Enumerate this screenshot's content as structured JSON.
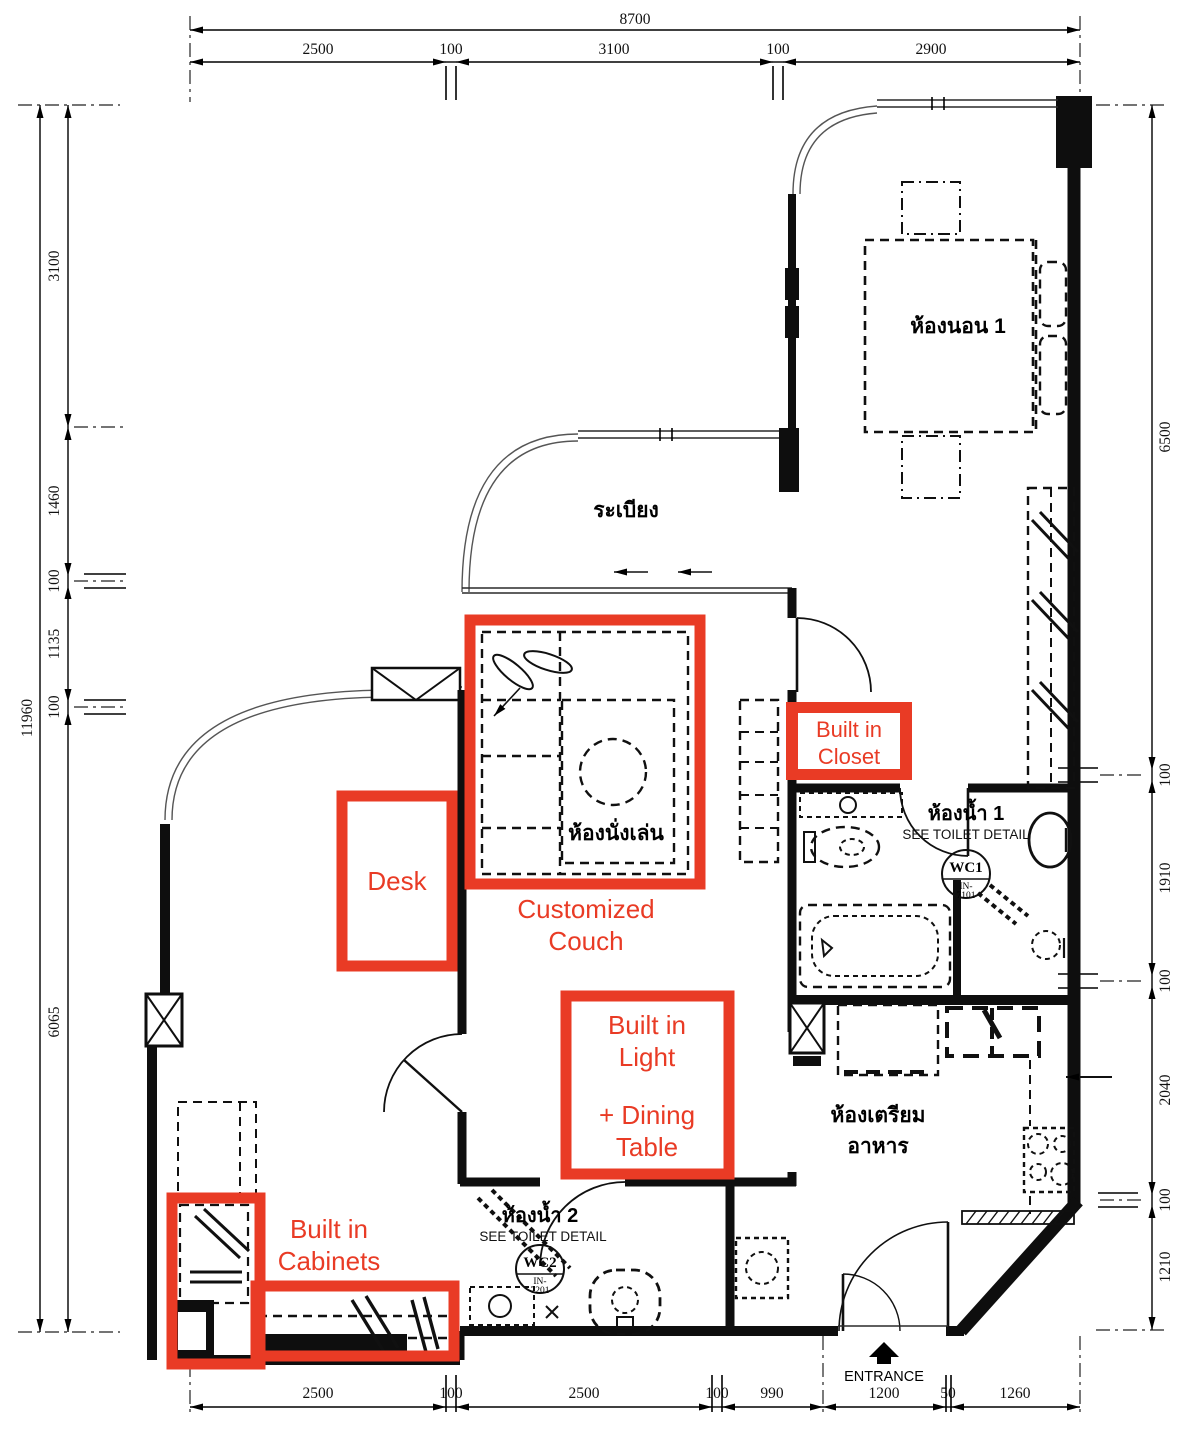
{
  "annotation_color": "#e93b25",
  "dimensions": {
    "top": {
      "total": "8700",
      "segments": [
        "2500",
        "100",
        "3100",
        "100",
        "2900"
      ]
    },
    "left": {
      "total": "11960",
      "segments": [
        "3100",
        "1460",
        "100",
        "1135",
        "100",
        "6065"
      ]
    },
    "right": {
      "segments": [
        "6500",
        "100",
        "1910",
        "100",
        "2040",
        "100",
        "1210"
      ]
    },
    "bottom": {
      "segments": [
        "2500",
        "100",
        "2500",
        "100",
        "990",
        "1200",
        "50",
        "1260"
      ]
    }
  },
  "rooms": {
    "bedroom1": "ห้องนอน 1",
    "balcony": "ระเบียง",
    "living": "ห้องนั่งเล่น",
    "bath1": {
      "name": "ห้องน้ำ 1",
      "note": "SEE TOILET DETAIL",
      "tag": "WC1",
      "ref1": "IN-",
      "ref2": "7101"
    },
    "kitchen": {
      "line1": "ห้องเตรียม",
      "line2": "อาหาร"
    },
    "bath2": {
      "name": "ห้องน้ำ 2",
      "note": "SEE TOILET DETAIL",
      "tag": "WC2",
      "ref1": "IN-",
      "ref2": "7201"
    }
  },
  "annotations": {
    "couch": {
      "line1": "Customized",
      "line2": "Couch"
    },
    "desk": {
      "label": "Desk"
    },
    "closet": {
      "line1": "Built in",
      "line2": "Closet"
    },
    "dining": {
      "line1": "Built in",
      "line2": "Light",
      "line3": "+ Dining",
      "line4": "Table"
    },
    "cabinets": {
      "line1": "Built in",
      "line2": "Cabinets"
    }
  },
  "entrance_label": "ENTRANCE"
}
